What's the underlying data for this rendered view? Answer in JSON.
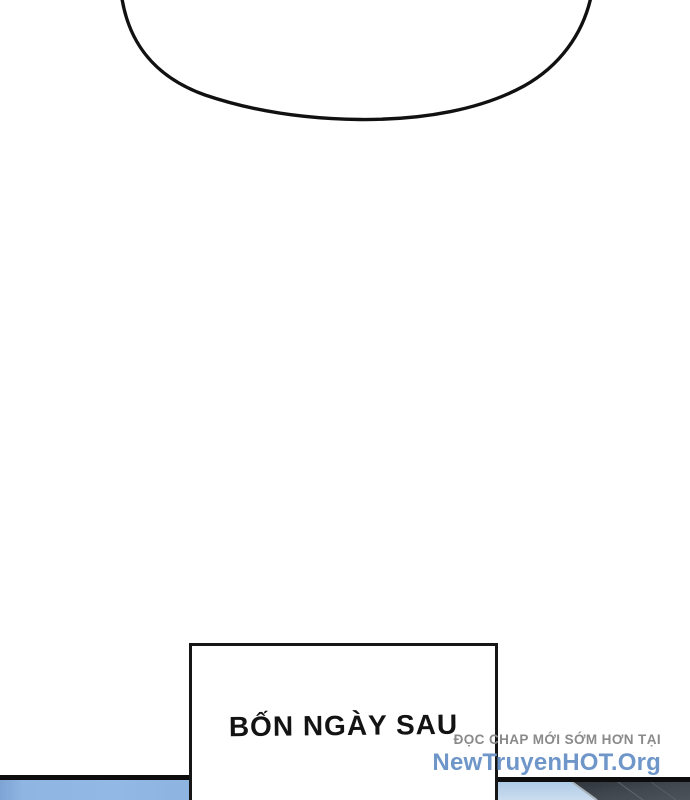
{
  "page": {
    "type": "webtoon-comic-strip",
    "background_color": "#ffffff"
  },
  "speech_bubble": {
    "fill_color": "#ffffff",
    "stroke_color": "#111111"
  },
  "caption_box": {
    "text": "BỐN NGÀY SAU",
    "text_color": "#131313",
    "fill_color": "#ffffff",
    "border_color": "#161616"
  },
  "watermark": {
    "line1": "ĐỌC CHAP MỚI SỚM HƠN TẠI",
    "line1_color": "#8a8a8a",
    "line2": "NewTruyenHOT.Org",
    "line2_color": "#6f96c8"
  },
  "bottom_panel": {
    "border_color": "#0d0d0d",
    "left_sky_color": "#8fb5e2",
    "right_sky_color": "#b9d2ea",
    "roof_color": "#383e45",
    "roof_highlight_color": "#a8b2ba"
  }
}
